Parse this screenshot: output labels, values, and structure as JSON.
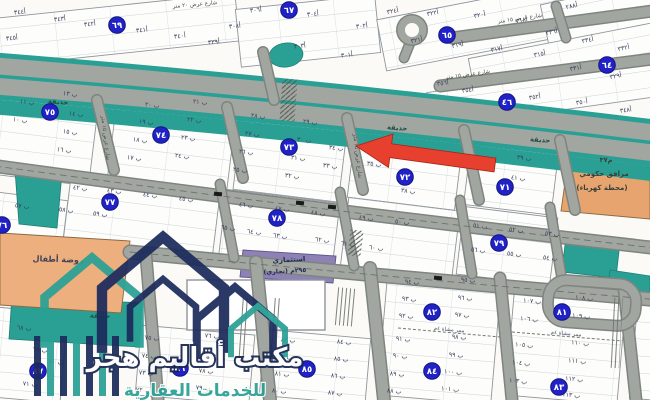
{
  "watermark": {
    "line1": "مكتب أقاليم هجر",
    "line2": "للخدمات العقارية"
  },
  "zones": {
    "kindergarten_label": "روضة أطفال",
    "gov_line1": "م٣٧",
    "gov_line2": "مرافق حكومي",
    "gov_line3": "(محطة كهرباء)",
    "commercial_line1": "استثماري",
    "commercial_line2": "(تجاري) ٢٩٥م"
  },
  "colors": {
    "teal": "#2aa095",
    "road_fill": "#a2a6a0",
    "road_casing": "#7e847f",
    "badge_blue": "#2022c8",
    "arrow_red": "#e8402f",
    "orange_zone": "#e7a46e",
    "purple_zone": "#8d81b5",
    "navy_logo": "#1c2b5c"
  },
  "map": {
    "blocks": [
      [
        -10,
        6,
        248,
        48,
        -6
      ],
      [
        238,
        2,
        140,
        58,
        -6
      ],
      [
        380,
        2,
        182,
        52,
        -11
      ],
      [
        545,
        -8,
        118,
        57,
        -12
      ],
      [
        470,
        40,
        192,
        36,
        -11
      ],
      [
        428,
        76,
        236,
        36,
        -8
      ],
      [
        -8,
        96,
        102,
        84,
        7
      ],
      [
        112,
        100,
        120,
        88,
        7
      ],
      [
        238,
        108,
        106,
        88,
        7
      ],
      [
        352,
        120,
        108,
        84,
        7
      ],
      [
        468,
        132,
        88,
        78,
        7
      ],
      [
        -10,
        196,
        74,
        68,
        7
      ],
      [
        66,
        186,
        150,
        72,
        7
      ],
      [
        222,
        196,
        114,
        72,
        7
      ],
      [
        344,
        204,
        112,
        72,
        7
      ],
      [
        460,
        212,
        94,
        68,
        7
      ],
      [
        -8,
        310,
        72,
        90,
        5
      ],
      [
        138,
        330,
        114,
        70,
        5
      ],
      [
        262,
        334,
        106,
        66,
        5
      ],
      [
        382,
        282,
        114,
        118,
        5
      ],
      [
        510,
        287,
        112,
        113,
        5
      ],
      [
        634,
        292,
        40,
        108,
        5
      ]
    ],
    "badges": [
      [
        "٦٩",
        117,
        25
      ],
      [
        "٦٧",
        289,
        10
      ],
      [
        "٦٥",
        447,
        35
      ],
      [
        "٦٤",
        607,
        65
      ],
      [
        "٤٦",
        507,
        102
      ],
      [
        "٧٥",
        50,
        112
      ],
      [
        "٧٤",
        161,
        135
      ],
      [
        "٧٣",
        289,
        147
      ],
      [
        "٧٢",
        405,
        177
      ],
      [
        "٧١",
        505,
        187
      ],
      [
        "٧٦",
        2,
        225
      ],
      [
        "٧٧",
        110,
        202
      ],
      [
        "٧٨",
        277,
        218
      ],
      [
        "٧٩",
        499,
        243
      ],
      [
        "٨٧",
        38,
        371
      ],
      [
        "٨٦",
        180,
        368
      ],
      [
        "٨٥",
        307,
        369
      ],
      [
        "٨٤",
        432,
        371
      ],
      [
        "٨٣",
        559,
        387
      ],
      [
        "٨٢",
        432,
        312
      ],
      [
        "٨١",
        562,
        312
      ]
    ],
    "plots": [
      [
        "أ٣٤٤",
        20,
        14,
        -6
      ],
      [
        "أ٣٤٣",
        60,
        21,
        -6
      ],
      [
        "أ٣٤٢",
        90,
        26,
        -6
      ],
      [
        "أ٣٤١",
        142,
        32,
        -6
      ],
      [
        "أ٣٤٠",
        180,
        38,
        -6
      ],
      [
        "أ٣٣٩",
        214,
        44,
        -6
      ],
      [
        "أ٣٤٥",
        12,
        40,
        -6
      ],
      [
        "أ٣٠٨",
        235,
        28,
        -6
      ],
      [
        "أ٣٠٦",
        256,
        12,
        -6
      ],
      [
        "أ٣٠٤",
        313,
        16,
        -6
      ],
      [
        "أ٣٠٢",
        362,
        28,
        -6
      ],
      [
        "أ٣٠٣",
        300,
        48,
        -6
      ],
      [
        "أ٣٠١",
        347,
        57,
        -6
      ],
      [
        "أ٣٢٤",
        393,
        13,
        -11
      ],
      [
        "أ٣٢٢",
        433,
        15,
        -11
      ],
      [
        "أ٣٢٠",
        480,
        17,
        -11
      ],
      [
        "أ٣١٨",
        522,
        22,
        -11
      ],
      [
        "أ٣٢١",
        417,
        42,
        -11
      ],
      [
        "أ٣١٩",
        458,
        47,
        -11
      ],
      [
        "أ٣١٧",
        497,
        51,
        -11
      ],
      [
        "أ٣١٥",
        540,
        56,
        -11
      ],
      [
        "أ٢٨٨",
        572,
        8,
        -12
      ],
      [
        "أ٣٣٦",
        552,
        34,
        -12
      ],
      [
        "أ٣٣٤",
        588,
        42,
        -12
      ],
      [
        "أ٣٣٢",
        624,
        50,
        -12
      ],
      [
        "أ٣٣١",
        576,
        70,
        -11
      ],
      [
        "أ٣٢٩",
        616,
        78,
        -11
      ],
      [
        "أ٣٥٦",
        443,
        85,
        -8
      ],
      [
        "أ٣٥٤",
        468,
        92,
        -8
      ],
      [
        "أ٣٥٢",
        535,
        99,
        -8
      ],
      [
        "أ٣٥٠",
        582,
        104,
        -8
      ],
      [
        "أ٣٤٨",
        626,
        112,
        -8
      ],
      [
        "ب ١٣",
        70,
        96,
        7
      ],
      [
        "ب ١١",
        27,
        104,
        7
      ],
      [
        "ب ١٤",
        76,
        116,
        7
      ],
      [
        "ب ١٠",
        20,
        122,
        7
      ],
      [
        "ب ١٥",
        70,
        134,
        7
      ],
      [
        "ب ١٦",
        64,
        152,
        7
      ],
      [
        "ب ٢١",
        200,
        104,
        7
      ],
      [
        "ب ٢٠",
        152,
        107,
        7
      ],
      [
        "ب ١٩",
        146,
        124,
        7
      ],
      [
        "ب ٢٢",
        194,
        122,
        7
      ],
      [
        "ب ٢٣",
        188,
        140,
        7
      ],
      [
        "ب ١٨",
        140,
        142,
        7
      ],
      [
        "ب ٢٤",
        182,
        158,
        7
      ],
      [
        "ب ١٧",
        134,
        160,
        7
      ],
      [
        "ب ٢٨",
        258,
        118,
        7
      ],
      [
        "ب ٢٧",
        252,
        136,
        7
      ],
      [
        "ب ٢٦",
        246,
        154,
        7
      ],
      [
        "ب ٢٥",
        240,
        172,
        7
      ],
      [
        "ب ٢٩",
        310,
        124,
        7
      ],
      [
        "ب ٣٠",
        304,
        142,
        7
      ],
      [
        "ب ٣١",
        298,
        160,
        7
      ],
      [
        "ب ٣٢",
        292,
        178,
        7
      ],
      [
        "ب ٣٤",
        336,
        150,
        7
      ],
      [
        "ب ٣٣",
        330,
        168,
        7
      ],
      [
        "ب ٣٦",
        380,
        147,
        7
      ],
      [
        "ب ٣٧",
        428,
        160,
        7
      ],
      [
        "ب ٣٥",
        374,
        166,
        7
      ],
      [
        "ب ٣٨",
        408,
        193,
        7
      ],
      [
        "ب ٣٩",
        524,
        160,
        7
      ],
      [
        "ب ٤٠",
        486,
        166,
        7
      ],
      [
        "ب ٤١",
        518,
        180,
        7
      ],
      [
        "ب ٥٧",
        22,
        208,
        7
      ],
      [
        "ب ٥٨",
        66,
        212,
        7
      ],
      [
        "ب ٥٩",
        100,
        216,
        7
      ],
      [
        "ب ٤٢",
        80,
        190,
        7
      ],
      [
        "ب ٤٣",
        114,
        193,
        7
      ],
      [
        "ب ٤٤",
        150,
        197,
        7
      ],
      [
        "ب ٤٥",
        186,
        201,
        7
      ],
      [
        "ب ٤٦",
        246,
        207,
        7
      ],
      [
        "ب ٤٧",
        282,
        211,
        7
      ],
      [
        "ب ٤٨",
        318,
        215,
        7
      ],
      [
        "ب ٦٥",
        228,
        230,
        7
      ],
      [
        "ب ٦٤",
        254,
        234,
        7
      ],
      [
        "ب ٦٣",
        280,
        238,
        7
      ],
      [
        "ب ٤٩",
        366,
        220,
        7
      ],
      [
        "ب ٥٠",
        402,
        224,
        7
      ],
      [
        "ب ٦٢",
        322,
        242,
        7
      ],
      [
        "ب ٦١",
        348,
        246,
        7
      ],
      [
        "ب ٦٠",
        376,
        250,
        7
      ],
      [
        "ب ٥١",
        480,
        228,
        7
      ],
      [
        "ب ٥٢",
        516,
        232,
        7
      ],
      [
        "ب ٥٣",
        552,
        236,
        7
      ],
      [
        "ب ٥٦",
        478,
        252,
        7
      ],
      [
        "ب ٥٥",
        514,
        256,
        7
      ],
      [
        "ب ٥٤",
        550,
        260,
        7
      ],
      [
        "ب ٦٨",
        24,
        330,
        5
      ],
      [
        "ب ٦٩",
        40,
        352,
        5
      ],
      [
        "ب ٧٠",
        56,
        364,
        5
      ],
      [
        "ب ٧١",
        30,
        386,
        5
      ],
      [
        "ب ٧٥",
        152,
        340,
        5
      ],
      [
        "ب ٧٤",
        149,
        358,
        5
      ],
      [
        "ب ٧٣",
        146,
        375,
        5
      ],
      [
        "ب ٧٢",
        143,
        392,
        5
      ],
      [
        "ب ٧٦",
        212,
        338,
        5
      ],
      [
        "ب ٧٧",
        209,
        356,
        5
      ],
      [
        "ب ٧٨",
        206,
        373,
        5
      ],
      [
        "ب ٧٩",
        203,
        390,
        5
      ],
      [
        "ب ٨٣",
        288,
        342,
        5
      ],
      [
        "ب ٨٢",
        285,
        359,
        5
      ],
      [
        "ب ٨١",
        282,
        376,
        5
      ],
      [
        "ب ٨٠",
        279,
        393,
        5
      ],
      [
        "ب ٨٤",
        344,
        344,
        5
      ],
      [
        "ب ٨٥",
        341,
        361,
        5
      ],
      [
        "ب ٨٦",
        338,
        378,
        5
      ],
      [
        "ب ٨٧",
        335,
        395,
        5
      ],
      [
        "ب ٩٤",
        412,
        284,
        5
      ],
      [
        "ب ٩٣",
        409,
        301,
        5
      ],
      [
        "ب ٩٢",
        406,
        318,
        5
      ],
      [
        "ب ٩٥",
        468,
        282,
        5
      ],
      [
        "ب ٩٦",
        465,
        300,
        5
      ],
      [
        "ب ٩٧",
        462,
        317,
        5
      ],
      [
        "ب ٩١",
        403,
        341,
        5
      ],
      [
        "ب ٩٠",
        400,
        358,
        5
      ],
      [
        "ب ٨٩",
        397,
        376,
        5
      ],
      [
        "ب ٨٨",
        394,
        393,
        5
      ],
      [
        "ب ٩٨",
        459,
        339,
        5
      ],
      [
        "ب ٩٩",
        456,
        357,
        5
      ],
      [
        "ب ١٠٠",
        453,
        374,
        5
      ],
      [
        "ب ١٠١",
        450,
        391,
        5
      ],
      [
        "ب ١٠٧",
        532,
        303,
        5
      ],
      [
        "ب ١٠٦",
        529,
        321,
        5
      ],
      [
        "ب ١٠٨",
        584,
        300,
        5
      ],
      [
        "ب ١٠٩",
        581,
        318,
        5
      ],
      [
        "ب ١٠٥",
        524,
        347,
        5
      ],
      [
        "ب ١٠٤",
        521,
        365,
        5
      ],
      [
        "ب ١٠٣",
        518,
        383,
        5
      ],
      [
        "ب ١١٠",
        580,
        345,
        5
      ],
      [
        "ب ١١١",
        577,
        363,
        5
      ],
      [
        "ب ١١٢",
        574,
        381,
        5
      ],
      [
        "ب ١١٣",
        571,
        397,
        5
      ]
    ],
    "street_labels": [
      [
        "شارع عرض ١٥ متر",
        520,
        20,
        -8
      ],
      [
        "شارع عرض ١٥ متر",
        468,
        76,
        -8
      ],
      [
        "شارع عرض ٢٠ متر",
        195,
        6,
        -5
      ],
      [
        "شارع عرض ١٥ متر",
        104,
        138,
        83
      ],
      [
        "شارع عرض ١٥ متر",
        356,
        156,
        83
      ]
    ],
    "garden_labels": [
      [
        "حديقة",
        58,
        104,
        4
      ],
      [
        "حديقة",
        397,
        130,
        4
      ],
      [
        "حديقة",
        540,
        142,
        4
      ],
      [
        "حديقة",
        100,
        318,
        2
      ]
    ],
    "path_labels": [
      [
        "ممر مشاة ٤م",
        449,
        331,
        5
      ],
      [
        "ممر مشاة ٤م",
        566,
        335,
        5
      ]
    ]
  }
}
